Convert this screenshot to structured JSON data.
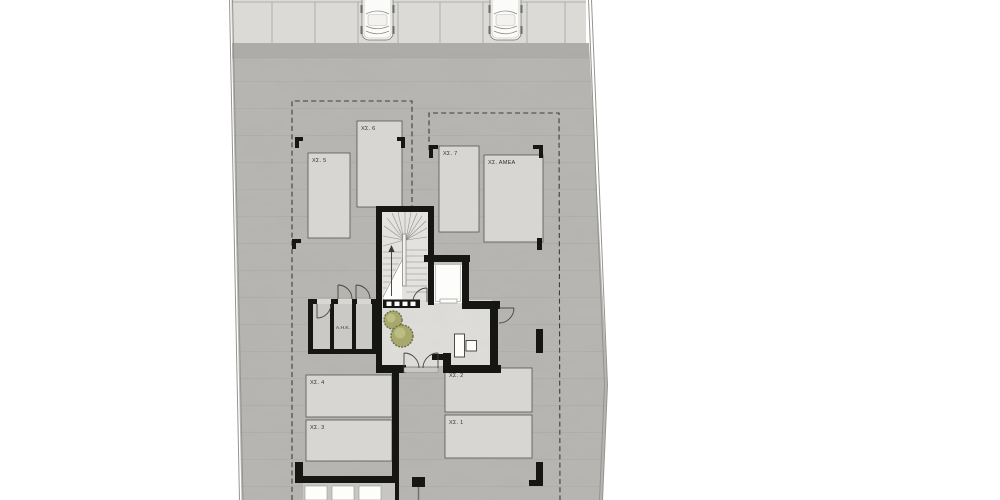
{
  "colors": {
    "paper": "#ffffff",
    "concrete": "#b5b4b0",
    "concrete-band": "#a9a8a4",
    "sidewalk": "#dbdad6",
    "stall": "#d7d6d2",
    "stall-line": "#55544f",
    "wall": "#161613",
    "lobby": "#dcdad6",
    "stair": "#e3e1dd",
    "dash": "#3f3e3a",
    "boundary": "#95948e",
    "door": "#45443e",
    "text": "#33322e",
    "plant": "#a6a96b",
    "plant-light": "#bcbd82",
    "plant-dark": "#6c7144",
    "white": "#fdfdfc"
  },
  "labels": {
    "parking_spaces": [
      {
        "id": "5",
        "label": "ΧΣ. 5"
      },
      {
        "id": "6",
        "label": "ΧΣ. 6"
      },
      {
        "id": "7",
        "label": "ΧΣ. 7"
      },
      {
        "id": "amea",
        "label": "ΧΣ. ΑΜΕΑ"
      },
      {
        "id": "4",
        "label": "ΧΣ. 4"
      },
      {
        "id": "3",
        "label": "ΧΣ. 3"
      },
      {
        "id": "2",
        "label": "ΧΣ. 2"
      },
      {
        "id": "1",
        "label": "ΧΣ. 1"
      }
    ],
    "rooms": [
      {
        "id": "ahk",
        "label": "Α.Η.Κ."
      }
    ]
  }
}
